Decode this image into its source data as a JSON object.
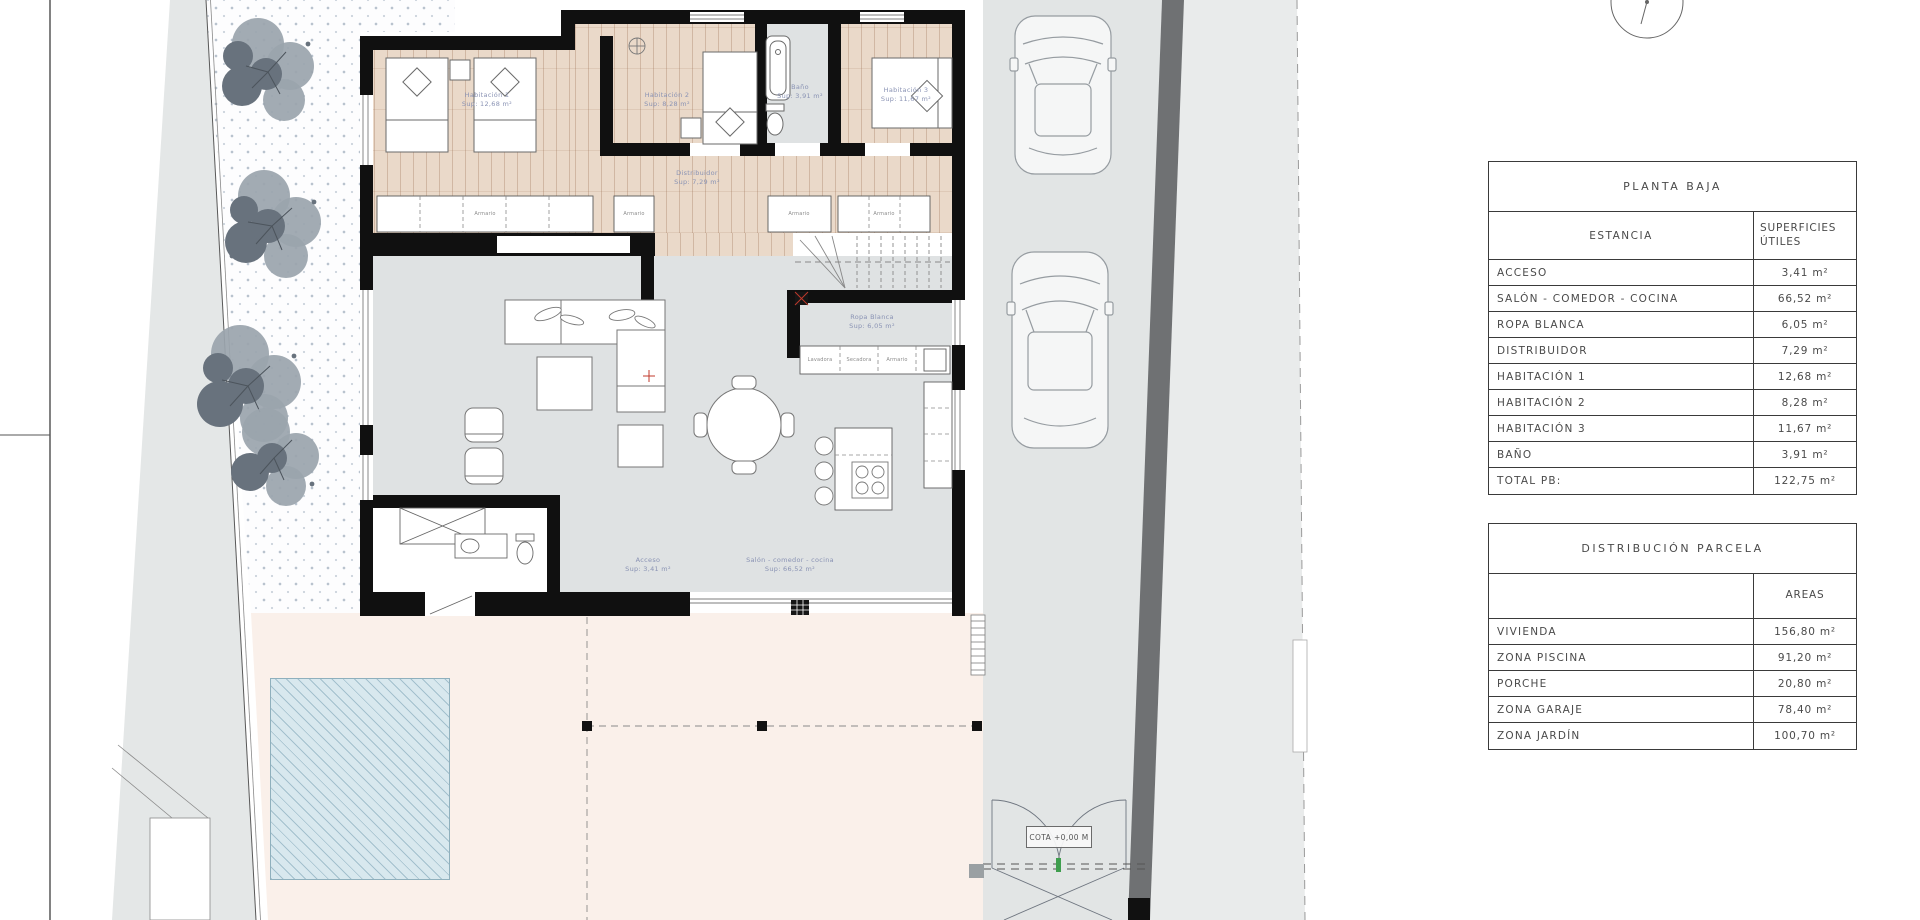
{
  "tables": {
    "planta_baja": {
      "title": "PLANTA BAJA",
      "col1": "ESTANCIA",
      "col2_line1": "SUPERFICIES",
      "col2_line2": "ÚTILES",
      "rows": [
        {
          "label": "ACCESO",
          "value": "3,41 m²"
        },
        {
          "label": "SALÓN - COMEDOR - COCINA",
          "value": "66,52 m²"
        },
        {
          "label": "ROPA BLANCA",
          "value": "6,05 m²"
        },
        {
          "label": "DISTRIBUIDOR",
          "value": "7,29 m²"
        },
        {
          "label": "HABITACIÓN 1",
          "value": "12,68 m²"
        },
        {
          "label": "HABITACIÓN 2",
          "value": "8,28 m²"
        },
        {
          "label": "HABITACIÓN 3",
          "value": "11,67 m²"
        },
        {
          "label": "BAÑO",
          "value": "3,91 m²"
        },
        {
          "label": "TOTAL PB:",
          "value": "122,75 m²"
        }
      ]
    },
    "parcela": {
      "title": "DISTRIBUCIÓN PARCELA",
      "col2": "AREAS",
      "rows": [
        {
          "label": "VIVIENDA",
          "value": "156,80 m²"
        },
        {
          "label": "ZONA PISCINA",
          "value": "91,20 m²"
        },
        {
          "label": "PORCHE",
          "value": "20,80 m²"
        },
        {
          "label": "ZONA GARAJE",
          "value": "78,40 m²"
        },
        {
          "label": "ZONA JARDÍN",
          "value": "100,70 m²"
        }
      ]
    }
  },
  "plan": {
    "rooms": {
      "hab1": {
        "name": "Habitación 1",
        "area": "Sup: 12,68 m²"
      },
      "hab2": {
        "name": "Habitación 2",
        "area": "Sup: 8,28 m²"
      },
      "hab3": {
        "name": "Habitación 3",
        "area": "Sup: 11,67 m²"
      },
      "bano": {
        "name": "Baño",
        "area": "Sup: 3,91 m²"
      },
      "distribuidor": {
        "name": "Distribuidor",
        "area": "Sup: 7,29 m²"
      },
      "ropa_blanca": {
        "name": "Ropa Blanca",
        "area": "Sup: 6,05 m²"
      },
      "acceso": {
        "name": "Acceso",
        "area": "Sup: 3,41 m²"
      },
      "salon": {
        "name": "Salón - comedor - cocina",
        "area": "Sup: 66,52 m²"
      }
    },
    "cota_label": "COTA +0,00 M",
    "closet_label": "Armario",
    "laundry": [
      "Lavadora",
      "Secadora",
      "Armario"
    ]
  },
  "colors": {
    "wall": "#101010",
    "wood_floor": "#ead9c9",
    "gray_floor": "#dfe2e3",
    "porch": "#faf0ea",
    "pool": "#d8e8ee",
    "driveway": "#e2e5e5",
    "road_strip": "#6f7173",
    "room_label": "#8a93b4",
    "door_marker_red": "#c0392b",
    "gate_tick_green": "#3f9e4e"
  }
}
